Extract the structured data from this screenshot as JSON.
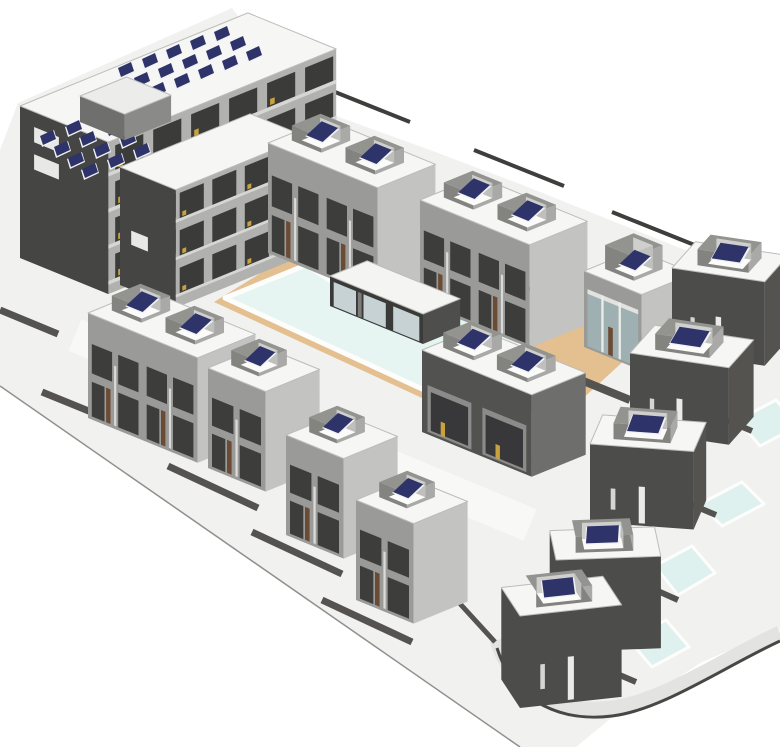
{
  "meta": {
    "view_name": "architectural-site-3d-model",
    "canvas": {
      "width": 780,
      "height": 747
    }
  },
  "colors": {
    "bg": "#ffffff",
    "ground": "#f1f1f0",
    "ground_edge": "#8f8f8d",
    "street": "#f8f8f7",
    "deck": "#e4bf90",
    "steps": "#d9b383",
    "step_line": "#8a6a42",
    "pool_water": "#e6f5f2",
    "pool_rim": "#fdfdfc",
    "private_pool": "#def1ee",
    "road_band": "#e3e3e2",
    "curb": "#474745",
    "wall": "#55534f",
    "wall_dark": "#403e3c",
    "roof": "#f6f6f5",
    "roof_line": "#bcbcba",
    "villa_front": "#9a9a98",
    "villa_side": "#c3c3c1",
    "villa_window": "#3d3d3c",
    "villa_mullion": "#dadad8",
    "door_brown": "#6b4b33",
    "dark_front": "#4c4c4a",
    "dark_side": "#55534f",
    "dark_door": "#eaeae8",
    "glass_band": "#9fb0b2",
    "apt_gable": "#454543",
    "apt_side": "#b1b1af",
    "apt_opening": "#3b3b39",
    "slab": "#d6d6d4",
    "gold": "#c8a23c",
    "panel_navy": "#2e3469",
    "panel_back": "#f2f2f4",
    "well_wall": "#83837f",
    "well_wall_side": "#a9a9a7",
    "well_rim": "#93938f",
    "well_floor": "#fbfbfa",
    "well_inner1": "#cfcfcd",
    "well_inner2": "#bfbfbd",
    "club_front": "#3a3a38",
    "club_side": "#4e4e4c",
    "club_glass": "#c6d2d4",
    "pent_front": "#6f6f6d",
    "pent_side": "#8a8a88",
    "pent_top": "#ececea",
    "balc_inset": "#8b8b89",
    "balc_dark": "#38383a"
  },
  "projection": {
    "ax": 0.93,
    "ay": 0.38
  },
  "ground": {
    "points": [
      [
        0,
        386
      ],
      [
        520,
        747
      ],
      [
        576,
        747
      ],
      [
        616,
        714
      ],
      [
        662,
        688
      ],
      [
        702,
        662
      ],
      [
        742,
        645
      ],
      [
        780,
        630
      ],
      [
        780,
        292
      ],
      [
        700,
        256
      ],
      [
        610,
        220
      ],
      [
        520,
        184
      ],
      [
        430,
        150
      ],
      [
        336,
        116
      ],
      [
        300,
        97
      ],
      [
        232,
        8
      ],
      [
        18,
        103
      ],
      [
        0,
        150
      ]
    ]
  },
  "ground_edge_line": [
    0,
    386,
    520,
    747
  ],
  "streets": [
    {
      "name": "main-street",
      "d": "M 75 335 L 530 525",
      "w": 34
    }
  ],
  "deck": {
    "points": [
      [
        214,
        302
      ],
      [
        298,
        250
      ],
      [
        340,
        241
      ],
      [
        455,
        257
      ],
      [
        650,
        337
      ],
      [
        568,
        412
      ],
      [
        448,
        410
      ]
    ]
  },
  "steps": {
    "points": [
      [
        296,
        262
      ],
      [
        330,
        248
      ],
      [
        344,
        254
      ],
      [
        310,
        269
      ]
    ],
    "lines": [
      [
        299,
        260,
        331,
        247
      ],
      [
        303,
        264,
        337,
        251
      ],
      [
        307,
        268,
        343,
        255
      ]
    ]
  },
  "pool": {
    "points": [
      [
        225,
        298
      ],
      [
        306,
        265
      ],
      [
        336,
        284
      ],
      [
        365,
        280
      ],
      [
        533,
        335
      ],
      [
        448,
        401
      ]
    ]
  },
  "private_pools": [
    {
      "name": "villa-pool-1",
      "points": [
        [
          738,
          420
        ],
        [
          776,
          400
        ],
        [
          798,
          426
        ],
        [
          760,
          446
        ]
      ]
    },
    {
      "name": "villa-pool-2",
      "points": [
        [
          700,
          504
        ],
        [
          742,
          482
        ],
        [
          764,
          504
        ],
        [
          722,
          526
        ]
      ]
    },
    {
      "name": "villa-pool-3",
      "points": [
        [
          655,
          566
        ],
        [
          692,
          546
        ],
        [
          715,
          573
        ],
        [
          678,
          595
        ]
      ]
    },
    {
      "name": "villa-pool-4",
      "points": [
        [
          629,
          640
        ],
        [
          666,
          620
        ],
        [
          689,
          647
        ],
        [
          652,
          667
        ]
      ]
    }
  ],
  "road": {
    "band": "M 497 640 C 515 697 565 714 612 708 C 662 702 722 660 780 633",
    "curb": "M 497 648 C 515 705 565 722 612 716 C 662 710 722 668 780 641",
    "width": 15
  },
  "walls": [
    {
      "pts": [
        0,
        310,
        58,
        334
      ],
      "w": 7,
      "dark": false
    },
    {
      "pts": [
        42,
        392,
        160,
        440
      ],
      "w": 7,
      "dark": false
    },
    {
      "pts": [
        168,
        466,
        258,
        508
      ],
      "w": 7,
      "dark": false
    },
    {
      "pts": [
        252,
        532,
        342,
        574
      ],
      "w": 7,
      "dark": false
    },
    {
      "pts": [
        322,
        600,
        412,
        642
      ],
      "w": 7,
      "dark": false
    },
    {
      "pts": [
        420,
        560,
        495,
        642
      ],
      "w": 5,
      "dark": false
    },
    {
      "pts": [
        320,
        86,
        410,
        122
      ],
      "w": 4,
      "dark": true
    },
    {
      "pts": [
        474,
        150,
        564,
        186
      ],
      "w": 4,
      "dark": true
    },
    {
      "pts": [
        612,
        212,
        702,
        248
      ],
      "w": 4,
      "dark": true
    },
    {
      "pts": [
        704,
        252,
        780,
        283
      ],
      "w": 4,
      "dark": true
    },
    {
      "pts": [
        442,
        254,
        562,
        302
      ],
      "w": 4,
      "dark": true
    },
    {
      "pts": [
        512,
        352,
        630,
        400
      ],
      "w": 8,
      "dark": false
    },
    {
      "pts": [
        630,
        400,
        688,
        404
      ],
      "w": 5,
      "dark": false
    },
    {
      "pts": [
        688,
        404,
        752,
        431
      ],
      "w": 6,
      "dark": false
    },
    {
      "pts": [
        652,
        488,
        716,
        515
      ],
      "w": 6,
      "dark": false
    },
    {
      "pts": [
        615,
        572,
        678,
        600
      ],
      "w": 6,
      "dark": false
    },
    {
      "pts": [
        580,
        658,
        636,
        682
      ],
      "w": 6,
      "dark": false
    }
  ],
  "buildings": [
    {
      "name": "courtyard-enclosure",
      "a": [
        196,
        252
      ],
      "rot": 0,
      "w": 46,
      "d": 28,
      "h": 18,
      "style": "court",
      "wells": []
    },
    {
      "name": "apartment-block",
      "a": [
        20,
        258
      ],
      "rot": 0,
      "w": 95,
      "d": 245,
      "h": 152,
      "style": "apartment",
      "wells": [],
      "solar": [
        {
          "o": [
            118,
            68
          ],
          "cols": 5,
          "rows": 3,
          "cs": [
            24,
            -9
          ],
          "rs": [
            16,
            10
          ]
        },
        {
          "o": [
            40,
            136
          ],
          "cols": 3,
          "rows": 4,
          "cs": [
            26,
            -10
          ],
          "rs": [
            14,
            11
          ]
        }
      ]
    },
    {
      "name": "apartment-penthouse",
      "a": [
        80,
        122
      ],
      "rot": 0,
      "w": 48,
      "d": 50,
      "h": 26,
      "style": "penthouse",
      "wells": []
    },
    {
      "name": "apartment-wing",
      "a": [
        120,
        285
      ],
      "rot": 0,
      "w": 60,
      "d": 140,
      "h": 118,
      "style": "apartment-wing",
      "wells": []
    },
    {
      "name": "villa-pair-north-1",
      "a": [
        268,
        253
      ],
      "rot": 0,
      "w": 118,
      "d": 62,
      "h": 110,
      "style": "villa-pair",
      "wells": [
        {
          "fx": 0.08,
          "fy": 0.26,
          "fw": 0.27,
          "fd": 0.5,
          "wh": 15,
          "panel": true
        },
        {
          "fx": 0.57,
          "fy": 0.26,
          "fw": 0.27,
          "fd": 0.5,
          "wh": 15,
          "panel": true
        }
      ]
    },
    {
      "name": "villa-pair-north-2",
      "a": [
        420,
        303
      ],
      "rot": 0,
      "w": 118,
      "d": 62,
      "h": 103,
      "style": "villa-pair",
      "wells": [
        {
          "fx": 0.08,
          "fy": 0.26,
          "fw": 0.27,
          "fd": 0.5,
          "wh": 15,
          "panel": true
        },
        {
          "fx": 0.57,
          "fy": 0.26,
          "fw": 0.27,
          "fd": 0.5,
          "wh": 15,
          "panel": true
        }
      ]
    },
    {
      "name": "clubhouse",
      "a": [
        330,
        306
      ],
      "rot": 0,
      "w": 100,
      "d": 40,
      "h": 30,
      "style": "clubhouse",
      "wells": []
    },
    {
      "name": "villa-glass-east",
      "a": [
        584,
        347
      ],
      "rot": 0,
      "w": 62,
      "d": 56,
      "h": 76,
      "style": "villa-glass",
      "wells": [
        {
          "fx": 0.14,
          "fy": 0.25,
          "fw": 0.5,
          "fd": 0.55,
          "wh": 24,
          "panel": true
        }
      ]
    },
    {
      "name": "villa-corner-east",
      "a": [
        672,
        352
      ],
      "rot": 25,
      "w": 75,
      "d": 52,
      "h": 84,
      "style": "villa-dark",
      "wells": [
        {
          "fx": 0.22,
          "fy": 0.22,
          "fw": 0.55,
          "fd": 0.56,
          "wh": 16,
          "panel": true
        }
      ]
    },
    {
      "name": "villa-pair-west",
      "a": [
        88,
        418
      ],
      "rot": 0,
      "w": 118,
      "d": 62,
      "h": 105,
      "style": "villa-pair",
      "wells": [
        {
          "fx": 0.08,
          "fy": 0.26,
          "fw": 0.27,
          "fd": 0.5,
          "wh": 15,
          "panel": true
        },
        {
          "fx": 0.57,
          "fy": 0.26,
          "fw": 0.27,
          "fd": 0.5,
          "wh": 15,
          "panel": true
        }
      ]
    },
    {
      "name": "villa-east-row-1",
      "a": [
        630,
        430
      ],
      "rot": 25,
      "w": 80,
      "d": 55,
      "h": 77,
      "style": "villa-dark",
      "wells": [
        {
          "fx": 0.2,
          "fy": 0.22,
          "fw": 0.55,
          "fd": 0.56,
          "wh": 16,
          "panel": true
        }
      ]
    },
    {
      "name": "villa-center-pair",
      "a": [
        422,
        432
      ],
      "rot": 0,
      "w": 118,
      "d": 58,
      "h": 82,
      "style": "villa-balcony",
      "wells": [
        {
          "fx": 0.07,
          "fy": 0.25,
          "fw": 0.28,
          "fd": 0.52,
          "wh": 15,
          "panel": true
        },
        {
          "fx": 0.56,
          "fy": 0.25,
          "fw": 0.28,
          "fd": 0.52,
          "wh": 15,
          "panel": true
        }
      ]
    },
    {
      "name": "villa-west-2",
      "a": [
        208,
        468
      ],
      "rot": 0,
      "w": 62,
      "d": 58,
      "h": 100,
      "style": "villa",
      "wells": [
        {
          "fx": 0.14,
          "fy": 0.28,
          "fw": 0.48,
          "fd": 0.52,
          "wh": 15,
          "panel": true
        }
      ]
    },
    {
      "name": "villa-east-row-2",
      "a": [
        590,
        522
      ],
      "rot": 35,
      "w": 80,
      "d": 55,
      "h": 78,
      "style": "villa-dark",
      "wells": [
        {
          "fx": 0.2,
          "fy": 0.22,
          "fw": 0.55,
          "fd": 0.56,
          "wh": 16,
          "panel": true
        }
      ]
    },
    {
      "name": "villa-west-3",
      "a": [
        286,
        535
      ],
      "rot": 0,
      "w": 62,
      "d": 58,
      "h": 100,
      "style": "villa",
      "wells": [
        {
          "fx": 0.14,
          "fy": 0.28,
          "fw": 0.48,
          "fd": 0.52,
          "wh": 15,
          "panel": true
        }
      ]
    },
    {
      "name": "villa-west-4",
      "a": [
        356,
        600
      ],
      "rot": 0,
      "w": 62,
      "d": 58,
      "h": 100,
      "style": "villa",
      "wells": [
        {
          "fx": 0.14,
          "fy": 0.28,
          "fw": 0.48,
          "fd": 0.52,
          "wh": 15,
          "panel": true
        }
      ]
    },
    {
      "name": "villa-east-row-3",
      "a": [
        556,
        652
      ],
      "rot": 50,
      "w": 80,
      "d": 55,
      "h": 92,
      "style": "villa-dark",
      "wells": [
        {
          "fx": 0.2,
          "fy": 0.22,
          "fw": 0.55,
          "fd": 0.56,
          "wh": 16,
          "panel": true
        }
      ]
    },
    {
      "name": "villa-east-row-4",
      "a": [
        520,
        708
      ],
      "rot": 60,
      "w": 80,
      "d": 55,
      "h": 92,
      "style": "villa-dark",
      "wells": [
        {
          "fx": 0.2,
          "fy": 0.22,
          "fw": 0.55,
          "fd": 0.56,
          "wh": 16,
          "panel": true
        }
      ]
    }
  ]
}
